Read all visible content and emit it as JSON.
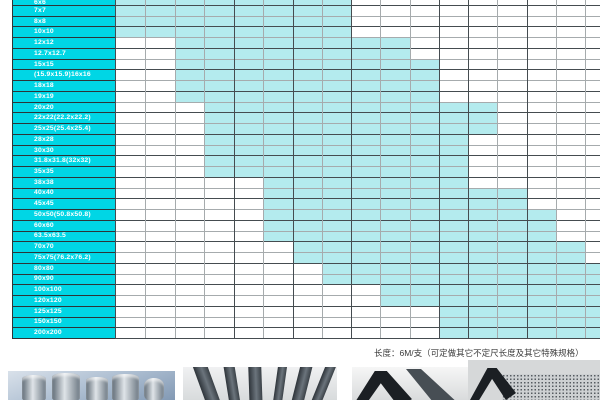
{
  "table": {
    "label_x": 12,
    "grid_x": 115,
    "right": 600,
    "first_row_h": 5,
    "row_h": 10.742,
    "bottom": 338,
    "col_boundaries": [
      115,
      145,
      175,
      204,
      234,
      263,
      293,
      322,
      351,
      380,
      410,
      439,
      468,
      497,
      527,
      556,
      585,
      600
    ],
    "dark_col_indices": [
      0,
      4,
      6,
      8,
      11,
      12,
      14
    ],
    "colors": {
      "label_bg": "#00d6e5",
      "fill": "#b4ebee",
      "line_light": "#a6abad",
      "line_dark": "#454c50",
      "label_line": "#2e3437",
      "label_text": "#ffffff"
    },
    "rows": [
      {
        "label": "6x6",
        "from": 0,
        "to": 8
      },
      {
        "label": "7x7",
        "from": 0,
        "to": 8
      },
      {
        "label": "8x8",
        "from": 0,
        "to": 8
      },
      {
        "label": "10x10",
        "from": 0,
        "to": 8
      },
      {
        "label": "12x12",
        "from": 2,
        "to": 10
      },
      {
        "label": "12.7x12.7",
        "from": 2,
        "to": 10
      },
      {
        "label": "15x15",
        "from": 2,
        "to": 11
      },
      {
        "label": "(15.9x15.9)16x16",
        "from": 2,
        "to": 11
      },
      {
        "label": "18x18",
        "from": 2,
        "to": 11
      },
      {
        "label": "19x19",
        "from": 2,
        "to": 11
      },
      {
        "label": "20x20",
        "from": 3,
        "to": 13
      },
      {
        "label": "22x22(22.2x22.2)",
        "from": 3,
        "to": 13
      },
      {
        "label": "25x25(25.4x25.4)",
        "from": 3,
        "to": 13
      },
      {
        "label": "28x28",
        "from": 3,
        "to": 12
      },
      {
        "label": "30x30",
        "from": 3,
        "to": 12
      },
      {
        "label": "31.8x31.8(32x32)",
        "from": 3,
        "to": 12
      },
      {
        "label": "35x35",
        "from": 3,
        "to": 12
      },
      {
        "label": "38x38",
        "from": 5,
        "to": 12
      },
      {
        "label": "40x40",
        "from": 5,
        "to": 14
      },
      {
        "label": "45x45",
        "from": 5,
        "to": 14
      },
      {
        "label": "50x50(50.8x50.8)",
        "from": 5,
        "to": 15
      },
      {
        "label": "60x60",
        "from": 5,
        "to": 15
      },
      {
        "label": "63.5x63.5",
        "from": 5,
        "to": 15
      },
      {
        "label": "70x70",
        "from": 6,
        "to": 16
      },
      {
        "label": "75x75(76.2x76.2)",
        "from": 6,
        "to": 16
      },
      {
        "label": "80x80",
        "from": 7,
        "to": 17
      },
      {
        "label": "90x90",
        "from": 7,
        "to": 17
      },
      {
        "label": "100x100",
        "from": 9,
        "to": 17
      },
      {
        "label": "120x120",
        "from": 9,
        "to": 17
      },
      {
        "label": "125x125",
        "from": 11,
        "to": 17
      },
      {
        "label": "150x150",
        "from": 11,
        "to": 17
      },
      {
        "label": "200x200",
        "from": 11,
        "to": 17
      }
    ]
  },
  "chart_data": {
    "type": "table",
    "title": "",
    "note": "Column headers cropped out of view; columns are unlabeled thickness steps, index 0-16",
    "row_sizes": [
      "6x6",
      "7x7",
      "8x8",
      "10x10",
      "12x12",
      "12.7x12.7",
      "15x15",
      "(15.9x15.9)16x16",
      "18x18",
      "19x19",
      "20x20",
      "22x22(22.2x22.2)",
      "25x25(25.4x25.4)",
      "28x28",
      "30x30",
      "31.8x31.8(32x32)",
      "35x35",
      "38x38",
      "40x40",
      "45x45",
      "50x50(50.8x50.8)",
      "60x60",
      "63.5x63.5",
      "70x70",
      "75x75(76.2x76.2)",
      "80x80",
      "90x90",
      "100x100",
      "120x120",
      "125x125",
      "150x150",
      "200x200"
    ],
    "available_col_range_inclusive": [
      [
        0,
        7
      ],
      [
        0,
        7
      ],
      [
        0,
        7
      ],
      [
        0,
        7
      ],
      [
        2,
        9
      ],
      [
        2,
        9
      ],
      [
        2,
        10
      ],
      [
        2,
        10
      ],
      [
        2,
        10
      ],
      [
        2,
        10
      ],
      [
        3,
        12
      ],
      [
        3,
        12
      ],
      [
        3,
        12
      ],
      [
        3,
        11
      ],
      [
        3,
        11
      ],
      [
        3,
        11
      ],
      [
        3,
        11
      ],
      [
        5,
        11
      ],
      [
        5,
        13
      ],
      [
        5,
        13
      ],
      [
        5,
        14
      ],
      [
        5,
        14
      ],
      [
        5,
        14
      ],
      [
        6,
        15
      ],
      [
        6,
        15
      ],
      [
        7,
        16
      ],
      [
        7,
        16
      ],
      [
        9,
        16
      ],
      [
        9,
        16
      ],
      [
        11,
        16
      ],
      [
        11,
        16
      ],
      [
        11,
        16
      ]
    ],
    "legend": "cyan cell = size/thickness combination available"
  },
  "footer": {
    "note": "长度：6M/支（可定做其它不定尺长度及其它特殊规格）"
  },
  "photos": {
    "round_bars": {
      "name": "stainless-round-bars-photo"
    },
    "flat_bars": {
      "name": "flat-steel-bars-photo"
    },
    "angle_steel": {
      "name": "angle-steel-photo"
    },
    "mesh": {
      "name": "mesh-texture-photo"
    }
  }
}
